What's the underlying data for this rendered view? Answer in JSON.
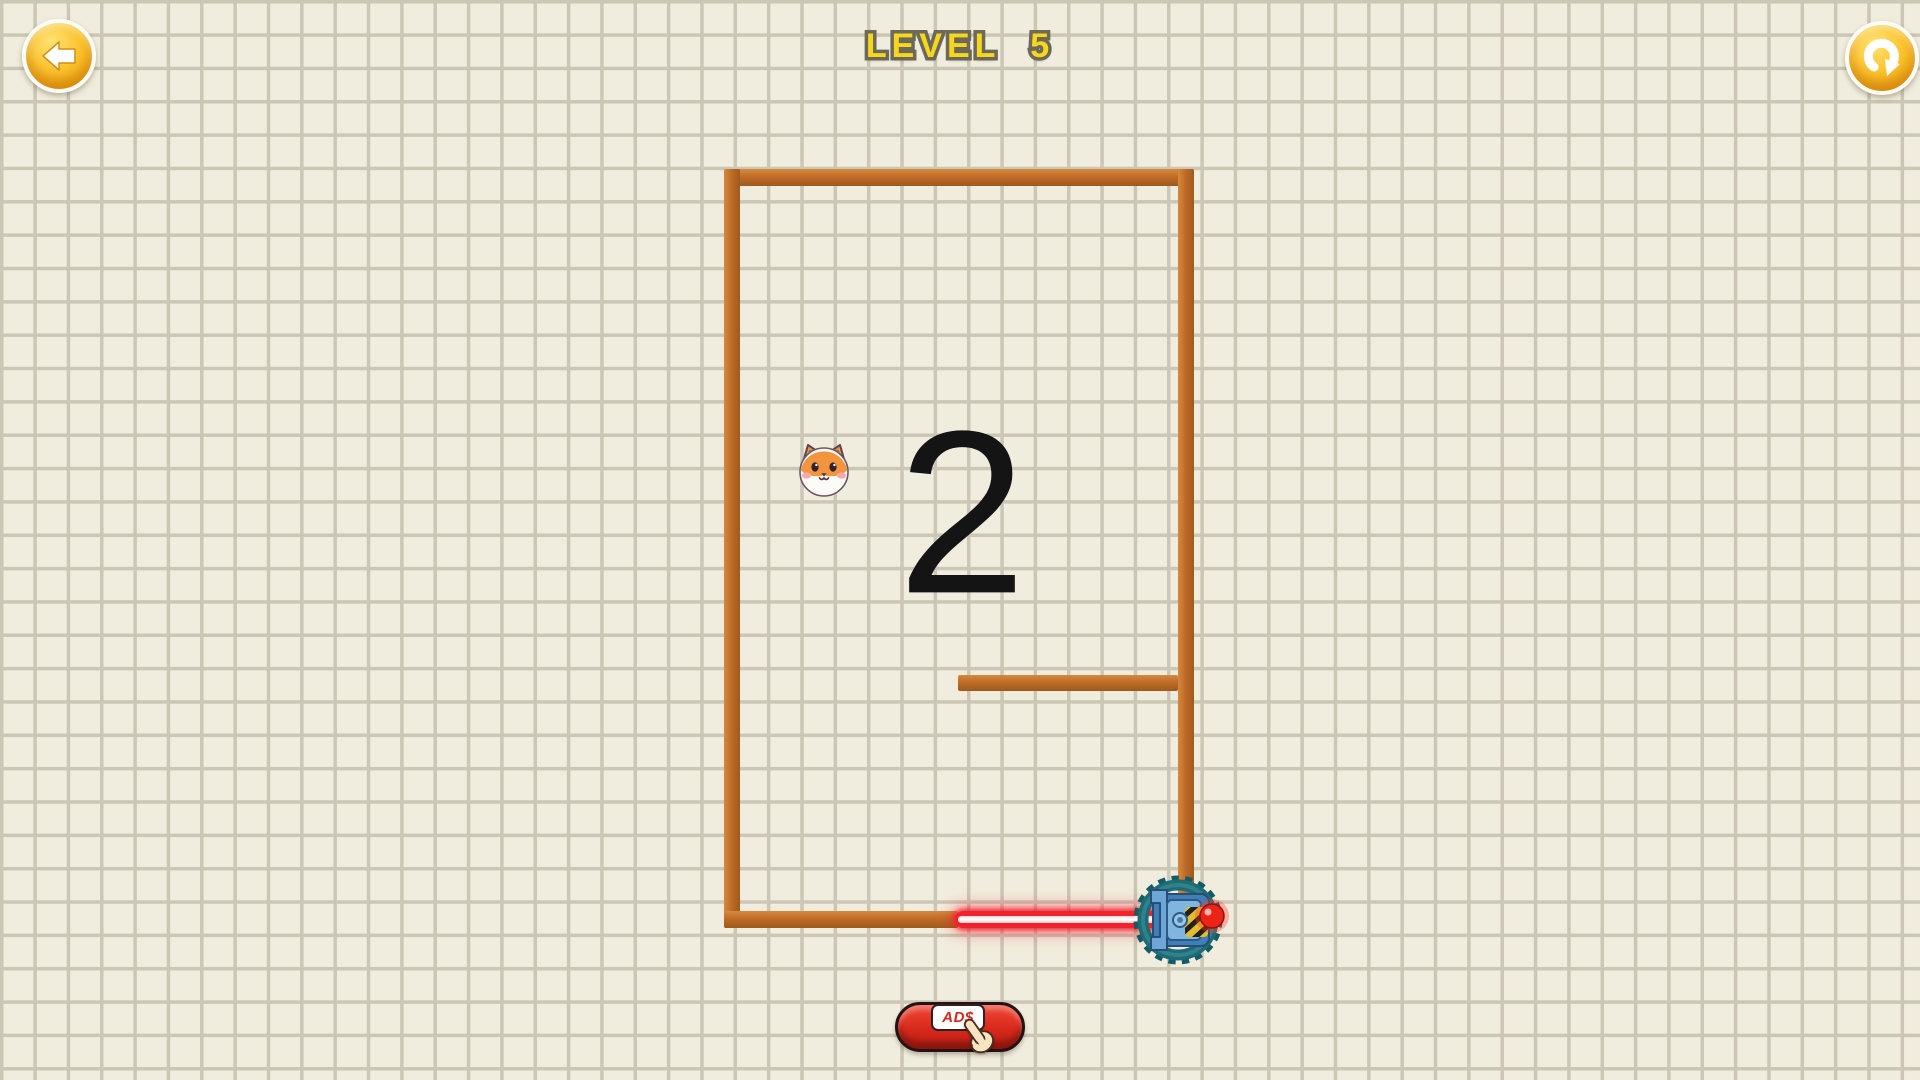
{
  "header": {
    "level_label": "LEVEL 5",
    "back_button": {
      "icon": "back-arrow-icon"
    },
    "restart_button": {
      "icon": "restart-icon"
    }
  },
  "game": {
    "counter": {
      "value": "2",
      "x": 962,
      "y": 518
    },
    "dog": {
      "icon": "shiba-dog-face",
      "x": 824,
      "y": 470
    },
    "maze": {
      "walls": [
        {
          "name": "wall-top",
          "x": 724,
          "y": 169,
          "w": 470,
          "h": 17
        },
        {
          "name": "wall-left",
          "x": 724,
          "y": 169,
          "w": 16,
          "h": 759
        },
        {
          "name": "wall-right",
          "x": 1178,
          "y": 169,
          "w": 16,
          "h": 735
        },
        {
          "name": "wall-bottom",
          "x": 724,
          "y": 911,
          "w": 234,
          "h": 17
        },
        {
          "name": "wall-middle",
          "x": 958,
          "y": 675,
          "w": 220,
          "h": 16
        }
      ],
      "laser": {
        "x": 955,
        "y": 911,
        "w": 208,
        "h": 17
      },
      "turret": {
        "icon": "laser-turret",
        "x": 1178,
        "y": 920
      }
    },
    "colors": {
      "background": "#f1edde",
      "grid_line": "#cbc6b6",
      "wall": "#c06c28",
      "wall_light": "#d6893e",
      "wall_dark": "#9e5a1c",
      "laser": "#f2222c",
      "title_yellow": "#f7d71e",
      "button_yellow": "#f7b722",
      "ads_red": "#d7281c",
      "counter_black": "#141414"
    }
  },
  "footer": {
    "ads_button": {
      "label": "AD$",
      "icon": "pointing-hand-icon"
    }
  }
}
